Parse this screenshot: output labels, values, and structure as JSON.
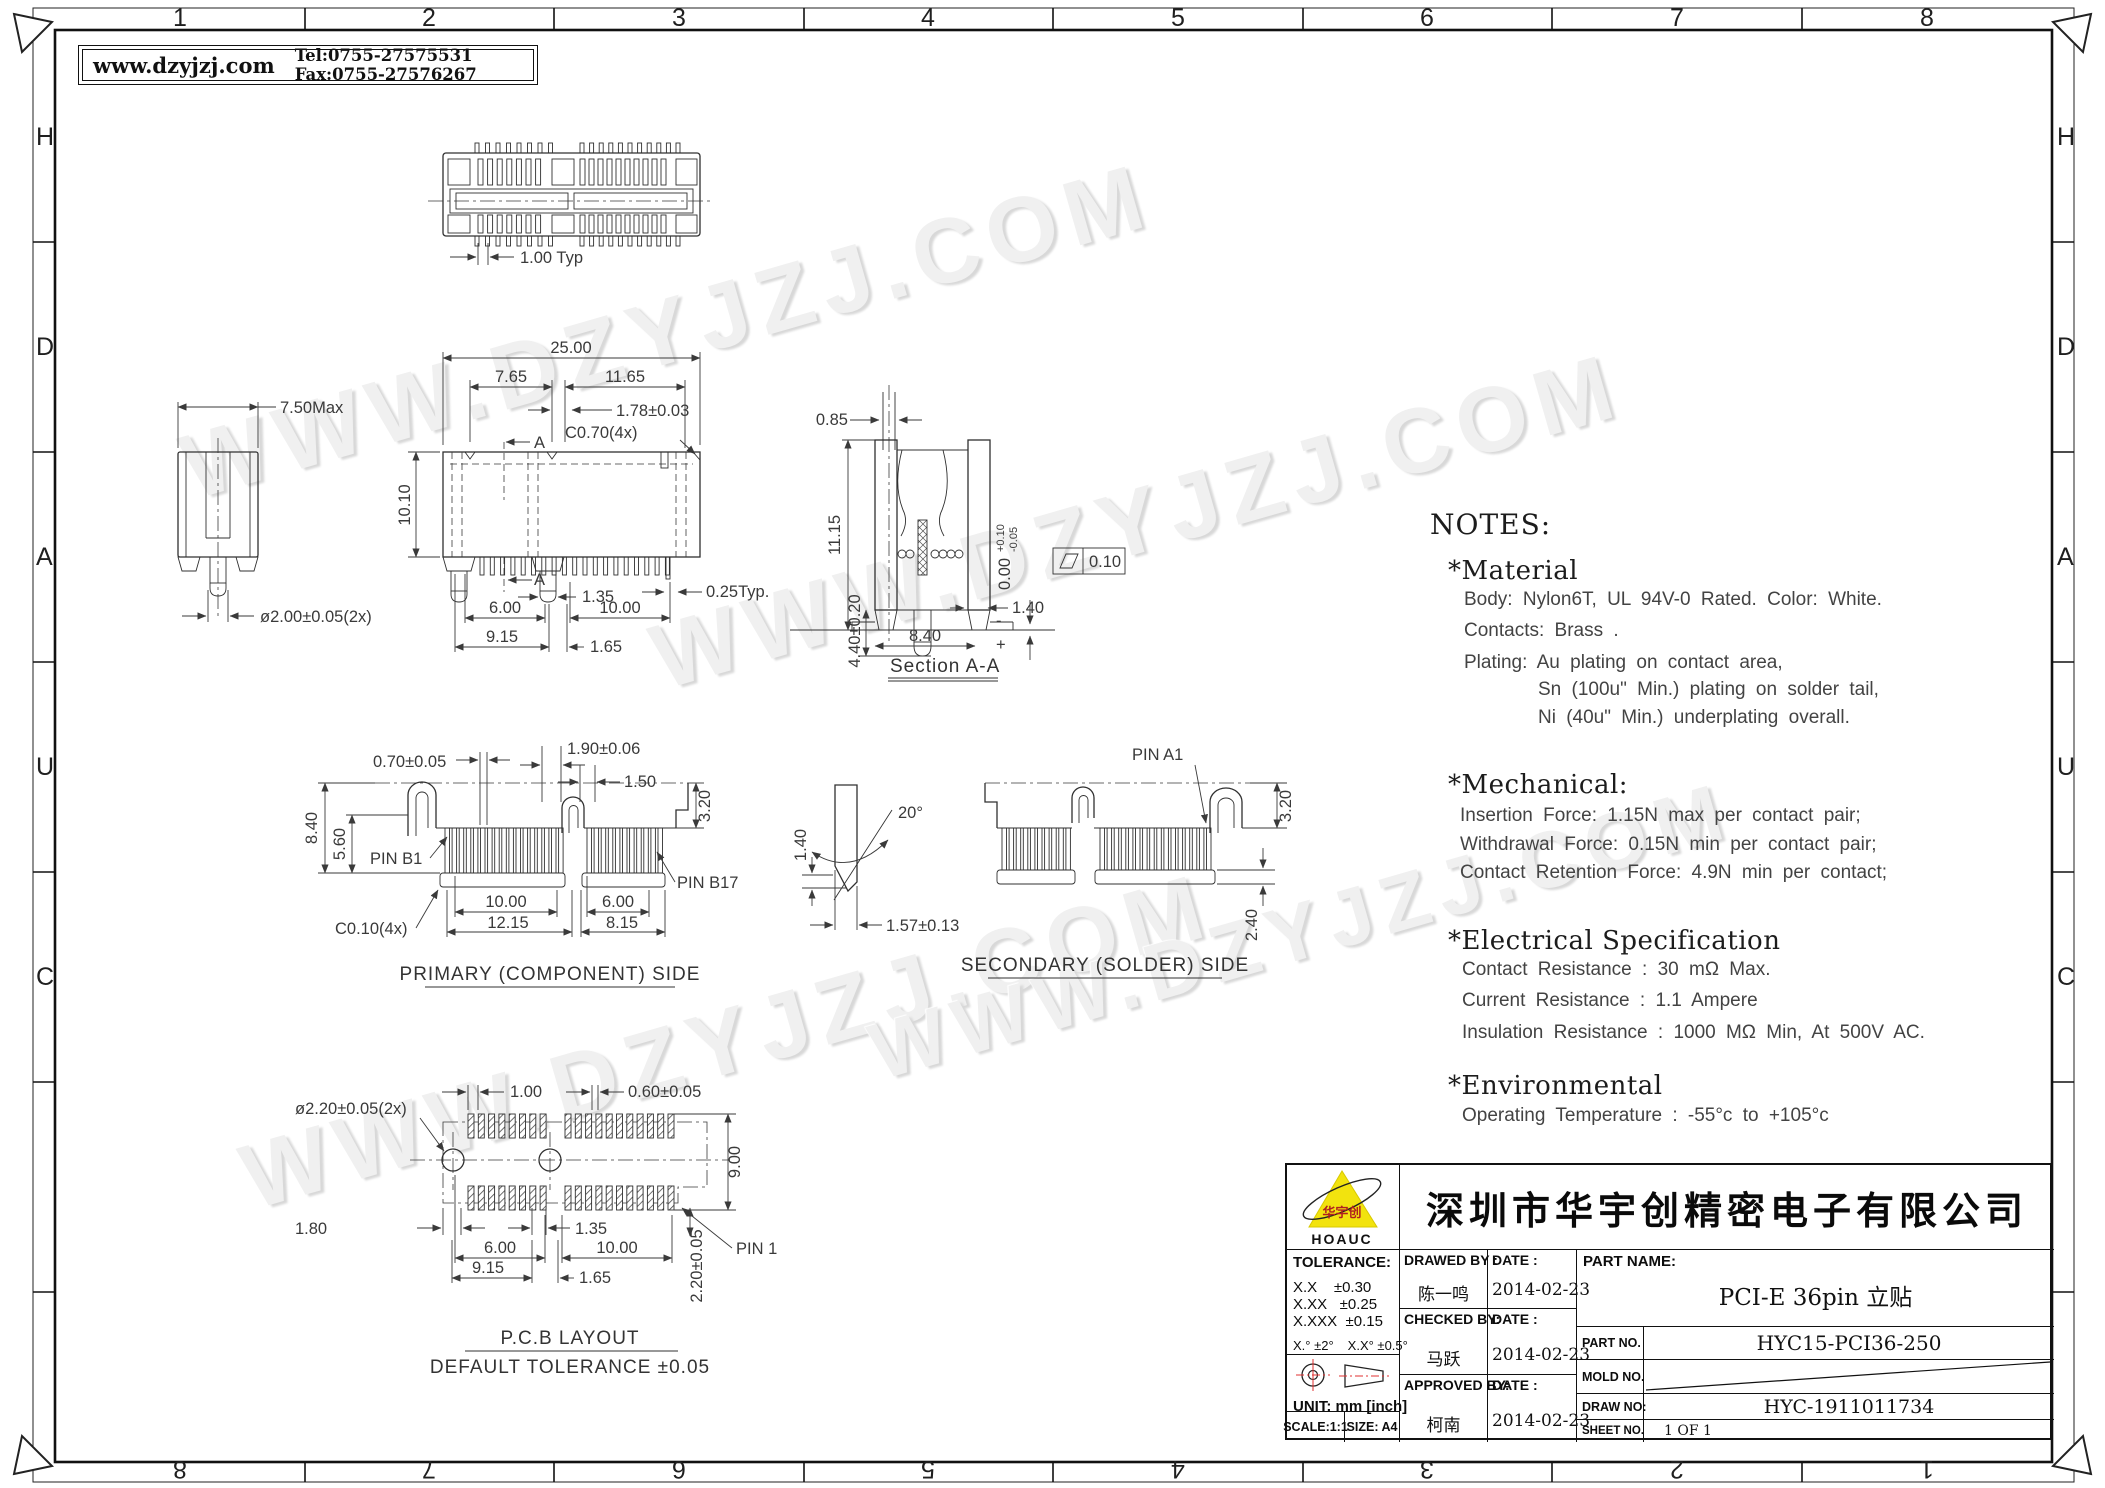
{
  "colors": {
    "logo_yellow": "#f2e30e",
    "symbol_red": "#e03030",
    "line": "#303030"
  },
  "header": {
    "website": "www.dzyjzj.com",
    "contact": "Tel:0755-27575531  Fax:0755-27576267"
  },
  "watermark": "WWW.DZYJZJ.COM",
  "border": {
    "top": [
      "1",
      "2",
      "3",
      "4",
      "5",
      "6",
      "7",
      "8"
    ],
    "bottom": [
      "8",
      "7",
      "6",
      "5",
      "4",
      "3",
      "2",
      "1"
    ],
    "left": [
      "H",
      "D",
      "A",
      "U",
      "C"
    ],
    "right": [
      "H",
      "D",
      "A",
      "U",
      "C"
    ]
  },
  "views": {
    "top": {
      "pitch": "1.00 Typ"
    },
    "side": {
      "width": "7.50Max",
      "peg": "ø2.00±0.05(2x)"
    },
    "front": {
      "total": "25.00",
      "left": "7.65",
      "right": "11.65",
      "slot": "1.78±0.03",
      "chamfer": "C0.70(4x)",
      "height": "10.10",
      "sec": "A",
      "peg_w": "1.35",
      "pin_w": "0.25Typ.",
      "peg_sp": "6.00",
      "pin_sp": "10.00",
      "hole_sp": "9.15",
      "off": "1.65"
    },
    "section": {
      "label": "Section A-A",
      "slot": "0.85",
      "height": "11.15",
      "tail": "4.40±0.20",
      "width": "8.40",
      "foot": "1.40",
      "coplanarity": "0.00",
      "tol_plus": "+0.10",
      "tol_minus": "-0.05",
      "flatness": "0.10",
      "minus": "-",
      "plus": "+"
    },
    "primary": {
      "label": "PRIMARY (COMPONENT) SIDE",
      "pad": "0.70±0.05",
      "key": "1.90±0.06",
      "key2": "1.50",
      "tab": "3.20",
      "height": "8.40",
      "body": "5.60",
      "pin_b1": "PIN B1",
      "pin_b17": "PIN B17",
      "chamfer": "C0.10(4x)",
      "span1": "10.00",
      "span2": "6.00",
      "span3": "12.15",
      "span4": "8.15"
    },
    "contact": {
      "tip": "1.40",
      "angle": "20°",
      "width": "1.57±0.13"
    },
    "secondary": {
      "label": "SECONDARY (SOLDER) SIDE",
      "pin_a1": "PIN A1",
      "tab": "3.20",
      "tail": "2.40"
    },
    "pcb": {
      "label": "P.C.B LAYOUT",
      "tolerance": "DEFAULT TOLERANCE ±0.05",
      "hole": "ø2.20±0.05(2x)",
      "pitch": "1.00",
      "pad": "0.60±0.05",
      "rows": "9.00",
      "edge": "1.80",
      "slot": "1.35",
      "pin1": "PIN 1",
      "pad_len": "2.20±0.05",
      "span1": "6.00",
      "span2": "10.00",
      "span3": "9.15",
      "span4": "1.65"
    }
  },
  "notes": {
    "title": "NOTES:",
    "material": {
      "heading": "*Material",
      "lines": [
        "Body: Nylon6T, UL 94V-0 Rated. Color: White.",
        "Contacts: Brass .",
        "Plating: Au plating on contact area,",
        "Sn (100u\" Min.) plating on solder tail,",
        "Ni (40u\" Min.) underplating overall."
      ]
    },
    "mechanical": {
      "heading": "*Mechanical:",
      "lines": [
        "Insertion Force: 1.15N max per contact pair;",
        "Withdrawal Force: 0.15N min per contact pair;",
        "Contact Retention Force: 4.9N min per contact;"
      ]
    },
    "electrical": {
      "heading": "*Electrical Specification",
      "lines": [
        "Contact Resistance : 30 mΩ Max.",
        "Current Resistance : 1.1 Ampere",
        "Insulation Resistance : 1000 MΩ Min, At 500V AC."
      ]
    },
    "environmental": {
      "heading": "*Environmental",
      "lines": [
        "Operating Temperature : -55°c to +105°c"
      ]
    }
  },
  "title_block": {
    "logo": {
      "brand_cn": "华宇创",
      "brand_en": "HOAUC"
    },
    "company": "深圳市华宇创精密电子有限公司",
    "tolerance": {
      "title": "TOLERANCE:",
      "rows": [
        "X.X    ±0.30",
        "X.XX   ±0.25",
        "X.XXX  ±0.15"
      ],
      "deg1": "X.° ±2°",
      "deg2": "X.X° ±0.5°"
    },
    "unit": "UNIT: mm [inch]",
    "scale": "SCALE:1:1",
    "size": "SIZE: A4",
    "drawed": {
      "label": "DRAWED BY :",
      "name": "陈一鸣",
      "date_label": "DATE :",
      "date": "2014-02-23"
    },
    "checked": {
      "label": "CHECKED BY:",
      "name": "马跃",
      "date_label": "DATE :",
      "date": "2014-02-23"
    },
    "approved": {
      "label": "APPROVED BY:",
      "name": "柯南",
      "date_label": "DATE :",
      "date": "2014-02-23"
    },
    "part_name": {
      "label": "PART NAME:",
      "value": "PCI-E 36pin 立贴"
    },
    "part_no": {
      "label": "PART NO.",
      "value": "HYC15-PCI36-250"
    },
    "mold_no": {
      "label": "MOLD NO."
    },
    "draw_no": {
      "label": "DRAW NO:",
      "value": "HYC-1911011734"
    },
    "sheet_no": {
      "label": "SHEET NO.",
      "value": "1 OF 1"
    }
  }
}
